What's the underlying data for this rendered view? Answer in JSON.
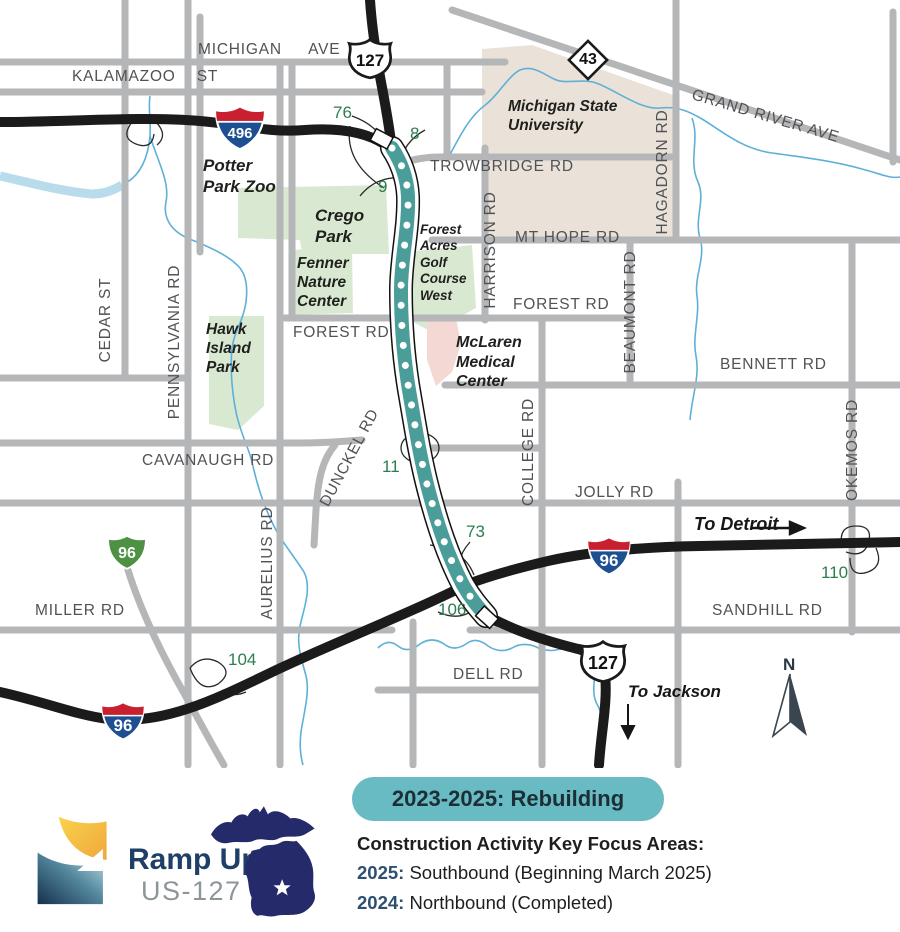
{
  "map": {
    "road_labels": {
      "michigan_ave": "MICHIGAN AVE",
      "kalamazoo_st": "KALAMAZOO ST",
      "grand_river_ave": "GRAND RIVER AVE",
      "trowbridge_rd": "TROWBRIDGE RD",
      "mt_hope_rd": "MT HOPE RD",
      "forest_rd_east": "FOREST RD",
      "forest_rd_west": "FOREST RD",
      "bennett_rd": "BENNETT RD",
      "cavanaugh_rd": "CAVANAUGH RD",
      "dunckel_rd": "DUNCKEL RD",
      "jolly_rd": "JOLLY RD",
      "miller_rd": "MILLER RD",
      "sandhill_rd": "SANDHILL RD",
      "dell_rd": "DELL RD",
      "cedar_st": "CEDAR ST",
      "pennsylvania_rd": "PENNSYLVANIA RD",
      "aurelius_rd": "AURELIUS RD",
      "harrison_rd": "HARRISON RD",
      "college_rd": "COLLEGE RD",
      "beaumont_rd": "BEAUMONT RD",
      "hagadorn_rd": "HAGADORN RD",
      "okemos_rd": "OKEMOS RD"
    },
    "place_labels": {
      "potter_park_zoo": "Potter Park Zoo",
      "crego_park": "Crego Park",
      "fenner_nature_center": "Fenner Nature Center",
      "hawk_island_park": "Hawk Island Park",
      "forest_acres_golf": "Forest Acres Golf Course West",
      "michigan_state_university": "Michigan State University",
      "mclaren_medical_center": "McLaren Medical Center"
    },
    "shields": {
      "i496": "496",
      "i96_main": "96",
      "i96_sw": "96",
      "bl96": "96",
      "us127_north": "127",
      "us127_south": "127",
      "m43": "43"
    },
    "exits": {
      "e76": "76",
      "e8": "8",
      "e9": "9",
      "e11": "11",
      "e73": "73",
      "e106": "106",
      "e104": "104",
      "e110": "110"
    },
    "directions": {
      "to_detroit": "To Detroit",
      "to_jackson": "To Jackson",
      "arrow_right": "→",
      "arrow_down": "↓"
    },
    "compass": {
      "north": "N"
    }
  },
  "legend": {
    "badge": "2023-2025: Rebuilding",
    "heading": "Construction Activity Key Focus Areas:",
    "items": [
      {
        "year": "2025:",
        "text": "Southbound (Beginning March 2025)"
      },
      {
        "year": "2024:",
        "text": "Northbound (Completed)"
      }
    ]
  },
  "logo": {
    "title": "Ramp Up",
    "subtitle": "US-127"
  },
  "colors": {
    "corridor_teal": "#4a9d98",
    "badge_teal": "#68bac3",
    "exit_green": "#2e7d4f",
    "park_green": "#d9e9d1",
    "campus_beige": "#eae2d8",
    "medical_pink": "#f4d8d3",
    "river_blue": "#62b0d9",
    "road_gray": "#b5b6b8",
    "freeway_black": "#1b1b1b",
    "legend_navy": "#2d4f70",
    "logo_navy": "#1e3f66"
  }
}
